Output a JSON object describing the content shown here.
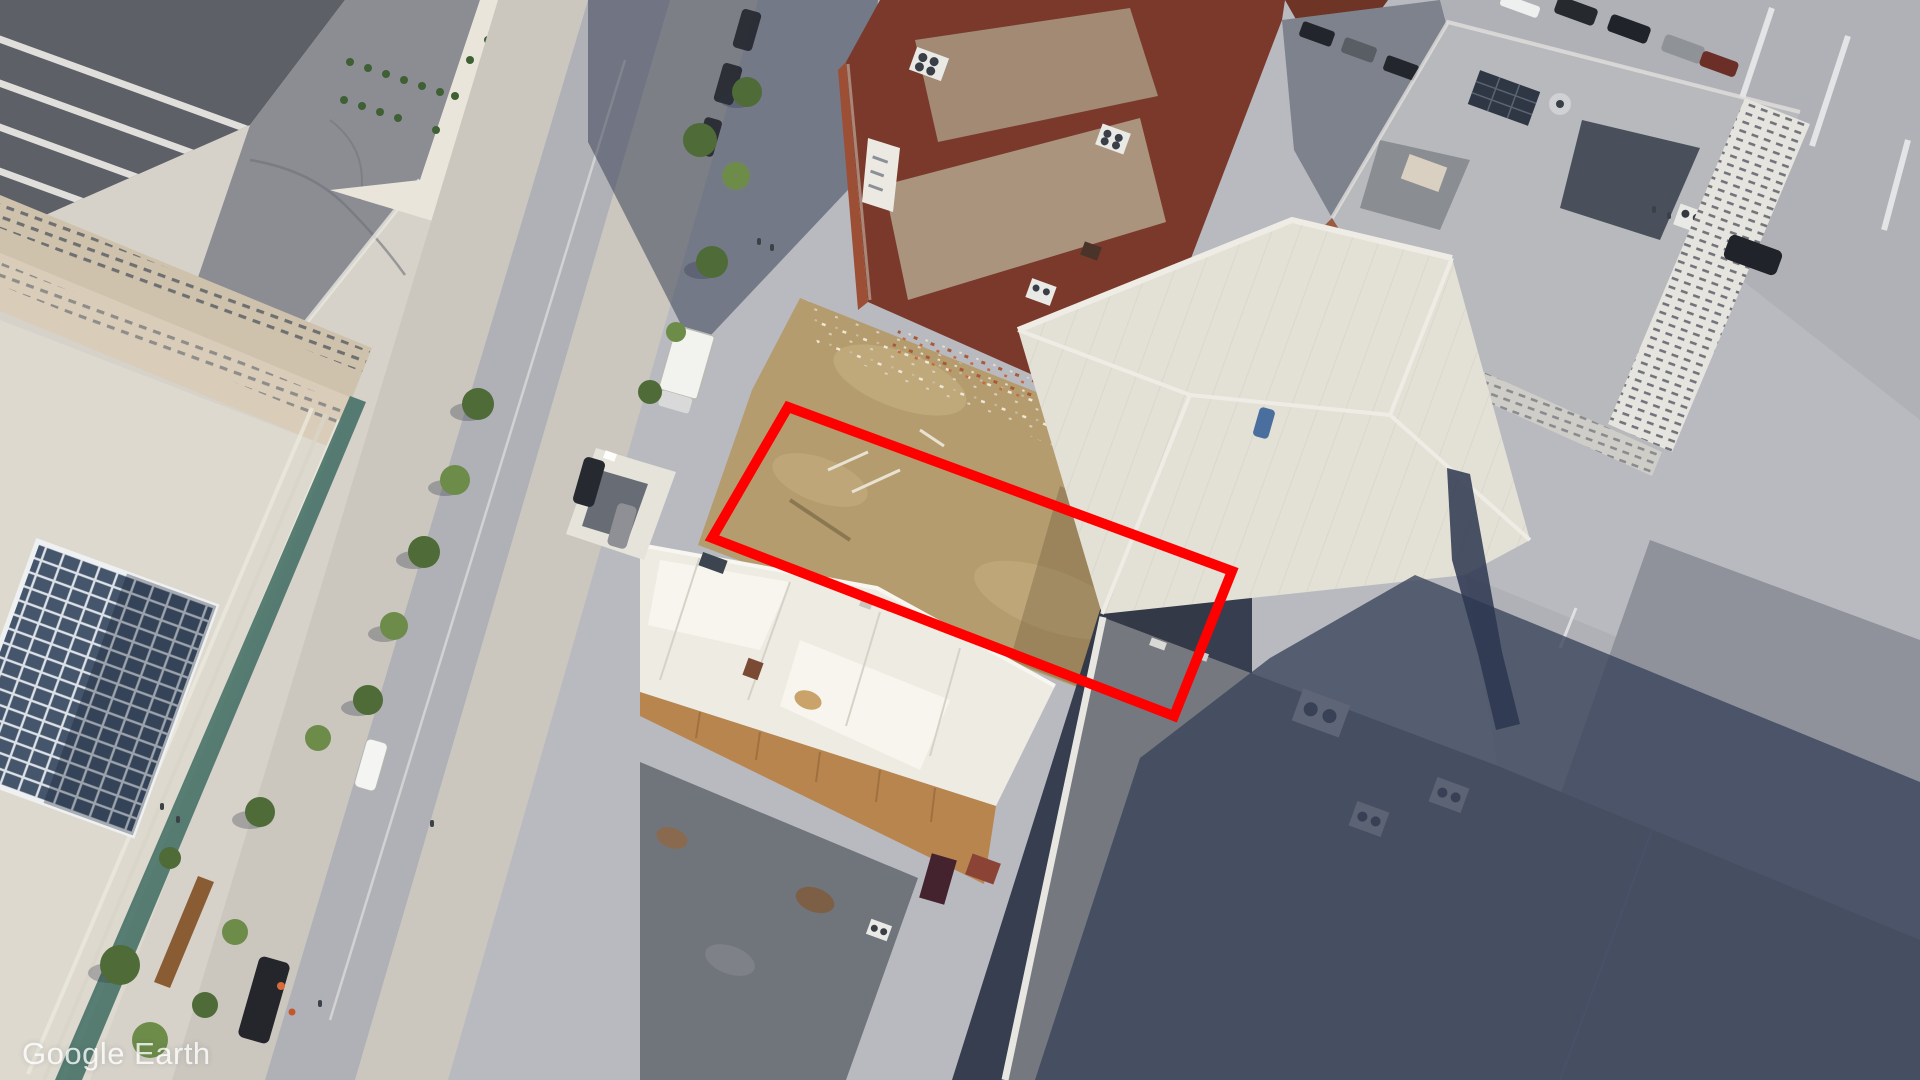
{
  "app": {
    "watermark": "Google Earth"
  },
  "annotation": {
    "shape": "quadrilateral-outline",
    "color": "#ff0000",
    "stroke_width": 10,
    "points": "788,407 1232,571 1174,716 712,538",
    "corners_px": [
      [
        788,
        407
      ],
      [
        1232,
        571
      ],
      [
        1174,
        716
      ],
      [
        712,
        538
      ]
    ]
  },
  "palette": {
    "base": "#b9bac0",
    "plaza": "#d6d2c9",
    "plazaBright": "#ddd9cf",
    "sidewalk": "#cbc7bf",
    "road": "#b0b1b7",
    "roadLine": "#e4e4e0",
    "sawtooth": "#5d6066",
    "grayRoof": "#8b8d93",
    "creamRoof": "#e9e5da",
    "facade": "#cfc2ac",
    "facade2": "#d9cdba",
    "teal": "#3e6b62",
    "glass": "#45556b",
    "bench": "#8a5c34",
    "dirt": "#b59c6e",
    "dirtLight": "#c2ab7d",
    "brick": "#7a392b",
    "brickLit": "#9c4f35",
    "brickRoof": "#a28a75",
    "brickRoof2": "#ab947e",
    "whiteRoof": "#eeebe2",
    "whiteBright": "#f7f5ee",
    "tanWall": "#b9854f",
    "wing": "#e6e3db",
    "wingPanel": "#686c74",
    "bottomRoof": "#70747b",
    "bottomRoof2": "#75787e",
    "parapet": "#e7e6e1",
    "redStruct": "#8a4334",
    "warehouse": "#e3e0d6",
    "ridge": "#f1efe8",
    "topRightRoof": "#b7b9bd",
    "topRightFacade": "#e6e4df",
    "brickWall": "#9a5a40",
    "darkRoofSection": "#3d4450",
    "alley": "#2b3346",
    "shadow": "#39425a",
    "chimneyShadow": "#2d3650",
    "streetShadow": "#2f3850",
    "treeDark": "#4e6b38",
    "treeLight": "#6d8c4a",
    "carBlack": "#202329",
    "carDark": "#26292f",
    "carGray": "#8e9095",
    "carWhite": "#f4f4f2",
    "carBlue": "#4a6e9e",
    "truck": "#f2f2ef",
    "ac": "#e9e9e6",
    "orange": "#d86b3a",
    "watermark": "#ffffff"
  }
}
